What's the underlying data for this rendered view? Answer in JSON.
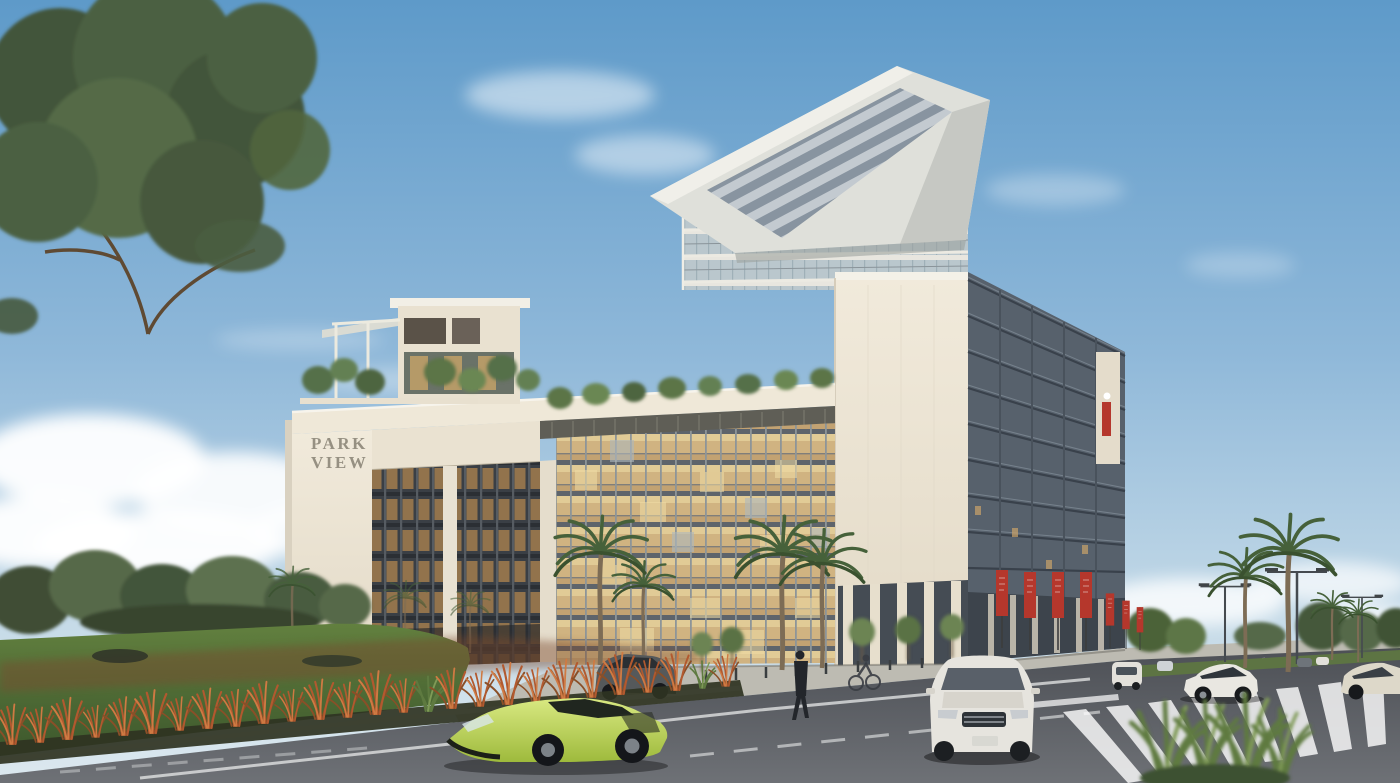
{
  "scene": {
    "type": "architectural-rendering",
    "title": "Park View building — street exterior rendering",
    "sign": {
      "line1": "PARK",
      "line2": "VIEW"
    },
    "palette": {
      "sky_top": "#5e9ac9",
      "sky_horizon": "#dce8ef",
      "building_cream": "#ece4d3",
      "building_fascia": "#f4f1e8",
      "glass_dark_facade": "#57616c",
      "glass_warm": "#caa972",
      "banner_red": "#b5372c",
      "lawn_green": "#5f7d41",
      "ornamental_grass_red": "#b2592f",
      "road_gray": "#53565b",
      "sports_car_lime": "#b8d14e",
      "suv_white": "#e6e4de"
    },
    "objects": {
      "building": "Park View mixed-use building with arch portal and roof canopy",
      "canopy": "cantilevered roof with louvers",
      "banners": "red vertical street banners",
      "cars": [
        "lime sports car",
        "white SUV facing viewer",
        "white SUV side view",
        "beige sedan",
        "dark parked SUV",
        "distant cars"
      ],
      "vegetation": [
        "large foreground tree",
        "palm trees",
        "rooftop trees",
        "lawn",
        "red ornamental grass bed",
        "roadside trees"
      ],
      "people": [
        "pedestrian walking",
        "cyclist"
      ]
    }
  }
}
